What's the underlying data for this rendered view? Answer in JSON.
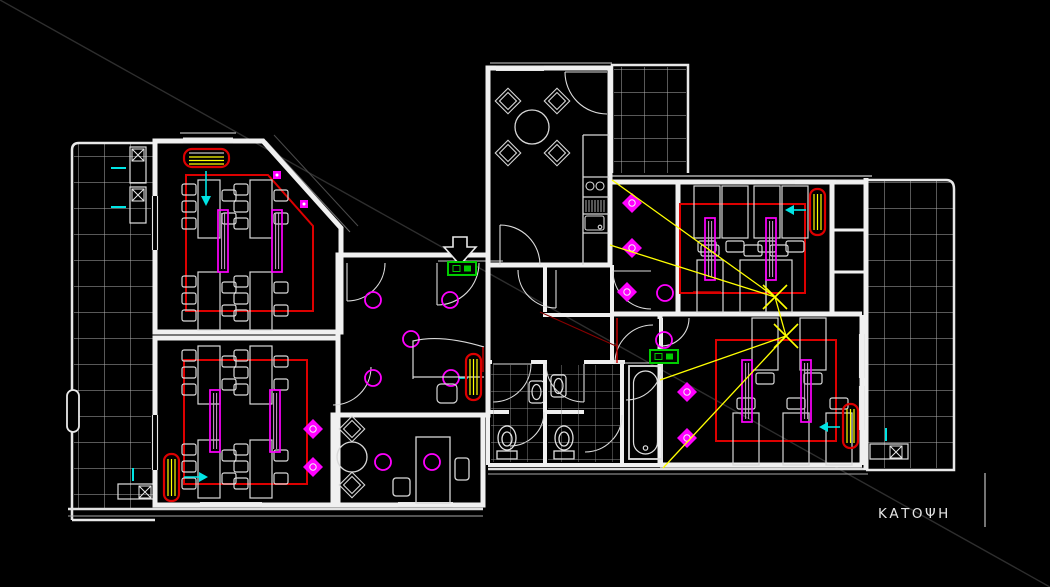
{
  "plan": {
    "label": "ΚΑΤΟΨΗ",
    "colors": {
      "background": "#000000",
      "walls": "#f0f0f0",
      "furniture": "#d8d8d8",
      "balcony_tiles": "#b0b0b0",
      "bath_tiles": "#8f8f8f",
      "cable_route": "#dd0000",
      "light_fixtures": "#ff00ff",
      "radiator_outline": "#dd0000",
      "radiator_fins": "#ffff00",
      "flow_arrows": "#00e5e5",
      "distribution_board": "#00cc00",
      "projection_lines": "#ffff00",
      "construction_line": "#2e2e2e",
      "label_text": "#e6e6e6"
    },
    "symbol_legend": {
      "ceiling-light-icon": "magenta circle",
      "ceiling-fixture-icon": "magenta diamond with white ring",
      "fluorescent-luminaire-icon": "magenta double bar",
      "wall-light-icon": "magenta square",
      "cable-route-icon": "red polyline loop",
      "radiator-icon": "red rounded box with yellow fins",
      "flow-arrow-icon": "cyan arrow",
      "distribution-board-icon": "green box",
      "projection-lines-icon": "yellow converging lines with X",
      "entrance-arrow-icon": "white outlined arrow",
      "ac-unit-icon": "white box with X"
    }
  }
}
